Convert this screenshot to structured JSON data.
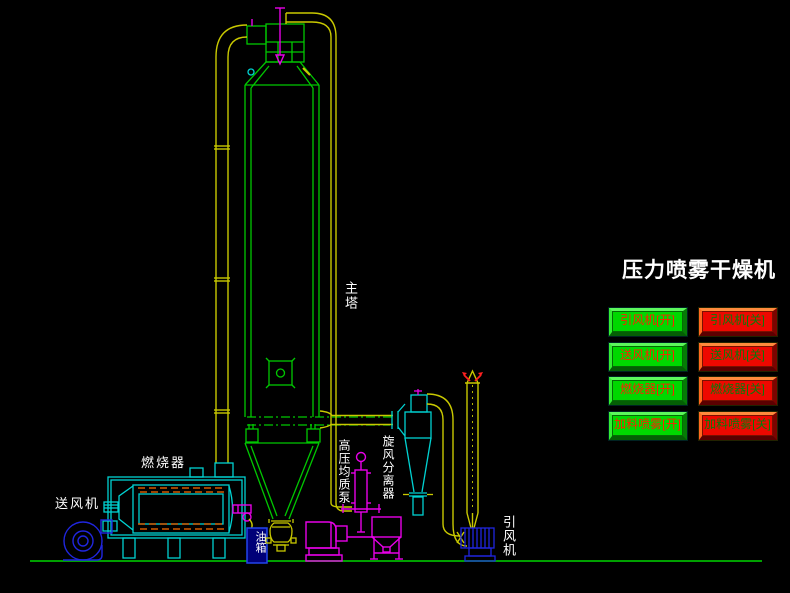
{
  "title": "压力喷雾干燥机",
  "equipment_labels": {
    "main_tower": "主塔",
    "burner": "燃烧器",
    "supply_fan": "送风机",
    "oil_tank": "油箱",
    "high_pressure_pump": "高压均质泵",
    "cyclone_separator": "旋风分离器",
    "induced_draft_fan": "引风机"
  },
  "buttons": {
    "on": [
      "引风机[开]",
      "送风机[开]",
      "燃烧器[开]",
      "加料喷雾[开]"
    ],
    "off": [
      "引风机[关]",
      "送风机[关]",
      "燃烧器[关]",
      "加料喷雾[关]"
    ]
  },
  "colors": {
    "background": "#000000",
    "line_green": "#00C800",
    "line_yellow": "#C9C900",
    "line_cyan": "#00D2D2",
    "line_magenta": "#E800E8",
    "line_blue": "#2026DF",
    "tube_orange": "#D25A00",
    "ground_green": "#00A000",
    "button_on_face": "#00D800",
    "button_on_text": "#FF2000",
    "button_off_face": "#EE0800",
    "button_off_text": "#0A7A0A",
    "title_text": "#FFFFFF"
  }
}
